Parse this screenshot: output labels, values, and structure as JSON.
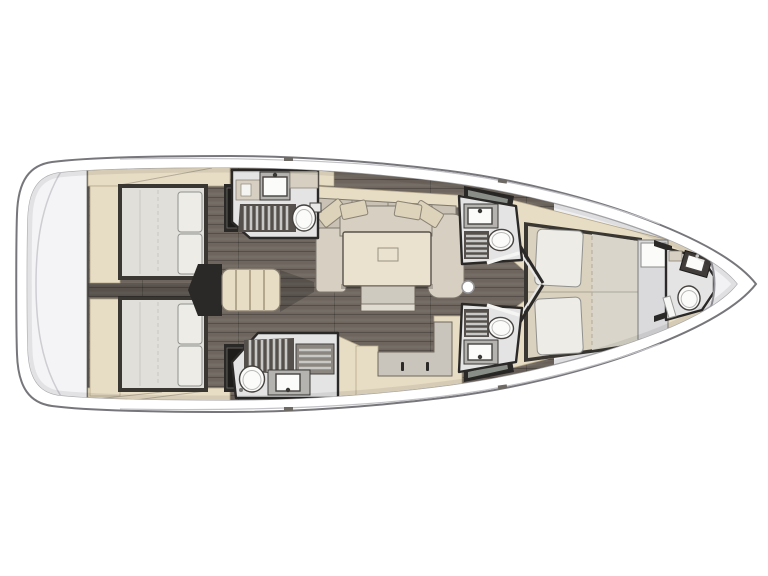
{
  "title": "Sailing yacht interior layout plan — top-down view, bow to the right",
  "type": "floor-plan",
  "colors": {
    "hull_band": "#ffffff",
    "hull_stroke": "#77777b",
    "deck": "#efeff1",
    "deck_stroke": "#a8a8ac",
    "transom": "#f4f4f6",
    "floor": "#6e665e",
    "floor_line": "#564f49",
    "wood": "#e7dcc4",
    "wood_edge": "#b6a98c",
    "sofa": "#d6cfc2",
    "sofa_back": "#c9c2b5",
    "cushion": "#ddd3ba",
    "table": "#eae2cf",
    "bench": "#cfcabf",
    "bed_frame": "#3a3733",
    "mattress": "#e0dfda",
    "mattress_tan": "#dad2bf",
    "mattress_lt": "#d9d5ca",
    "pillow": "#edece7",
    "bath_floor": "#e4e4e5",
    "grate_dark": "#55504b",
    "grate_slat": "#c8c8c6",
    "counter": "#b5b3b0",
    "cabinet": "#d7d0c2",
    "fixture": "#fbfbfa",
    "fixture_stroke": "#45423f",
    "wall": "#2b2927",
    "panel": "#dadadc",
    "glass": "#9aa09b",
    "shadow": "rgba(0,0,0,0.20)"
  },
  "legend": {
    "rooms": [
      {
        "id": "aft-cabin-top",
        "label": "aft-double-cabin"
      },
      {
        "id": "aft-cabin-bottom",
        "label": "aft-double-cabin"
      },
      {
        "id": "salon",
        "label": "salon-settee-and-table"
      },
      {
        "id": "aft-head-top",
        "label": "head-with-shower"
      },
      {
        "id": "aft-head-bottom",
        "label": "head-with-shower"
      },
      {
        "id": "fwd-head-top",
        "label": "head-with-shower"
      },
      {
        "id": "fwd-head-bottom",
        "label": "head-with-shower"
      },
      {
        "id": "forward-cabin",
        "label": "owner-v-berth-cabin"
      },
      {
        "id": "bow-head",
        "label": "forepeak-head"
      }
    ],
    "fixtures": [
      "toilet",
      "sink",
      "shower-grate",
      "companionway-steps",
      "saloon-table",
      "mast-step",
      "double-berth",
      "pillows",
      "transom-platform"
    ]
  }
}
